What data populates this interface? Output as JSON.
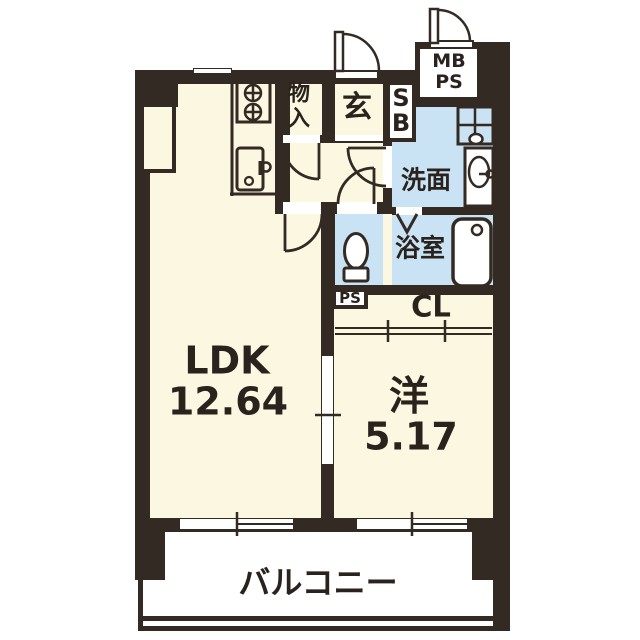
{
  "colors": {
    "wall": "#332a24",
    "floor": "#fbf7e1",
    "wet": "#c9e3f4",
    "ink": "#2a221d"
  },
  "rooms": {
    "ldk": {
      "name": "LDK",
      "area": "12.64"
    },
    "western": {
      "name": "洋",
      "area": "5.17"
    },
    "balcony": {
      "name": "バルコニー"
    },
    "washroom": {
      "name": "洗面"
    },
    "bathroom": {
      "name": "浴室"
    },
    "entrance": {
      "name": "玄"
    },
    "storage": {
      "name": "物\n入"
    },
    "shoe_box": {
      "name": "S\nB"
    },
    "meter_pipe_space": {
      "name": "MB\nPS"
    },
    "pipe_space": {
      "name": "PS"
    },
    "closet": {
      "name": "CL"
    }
  }
}
